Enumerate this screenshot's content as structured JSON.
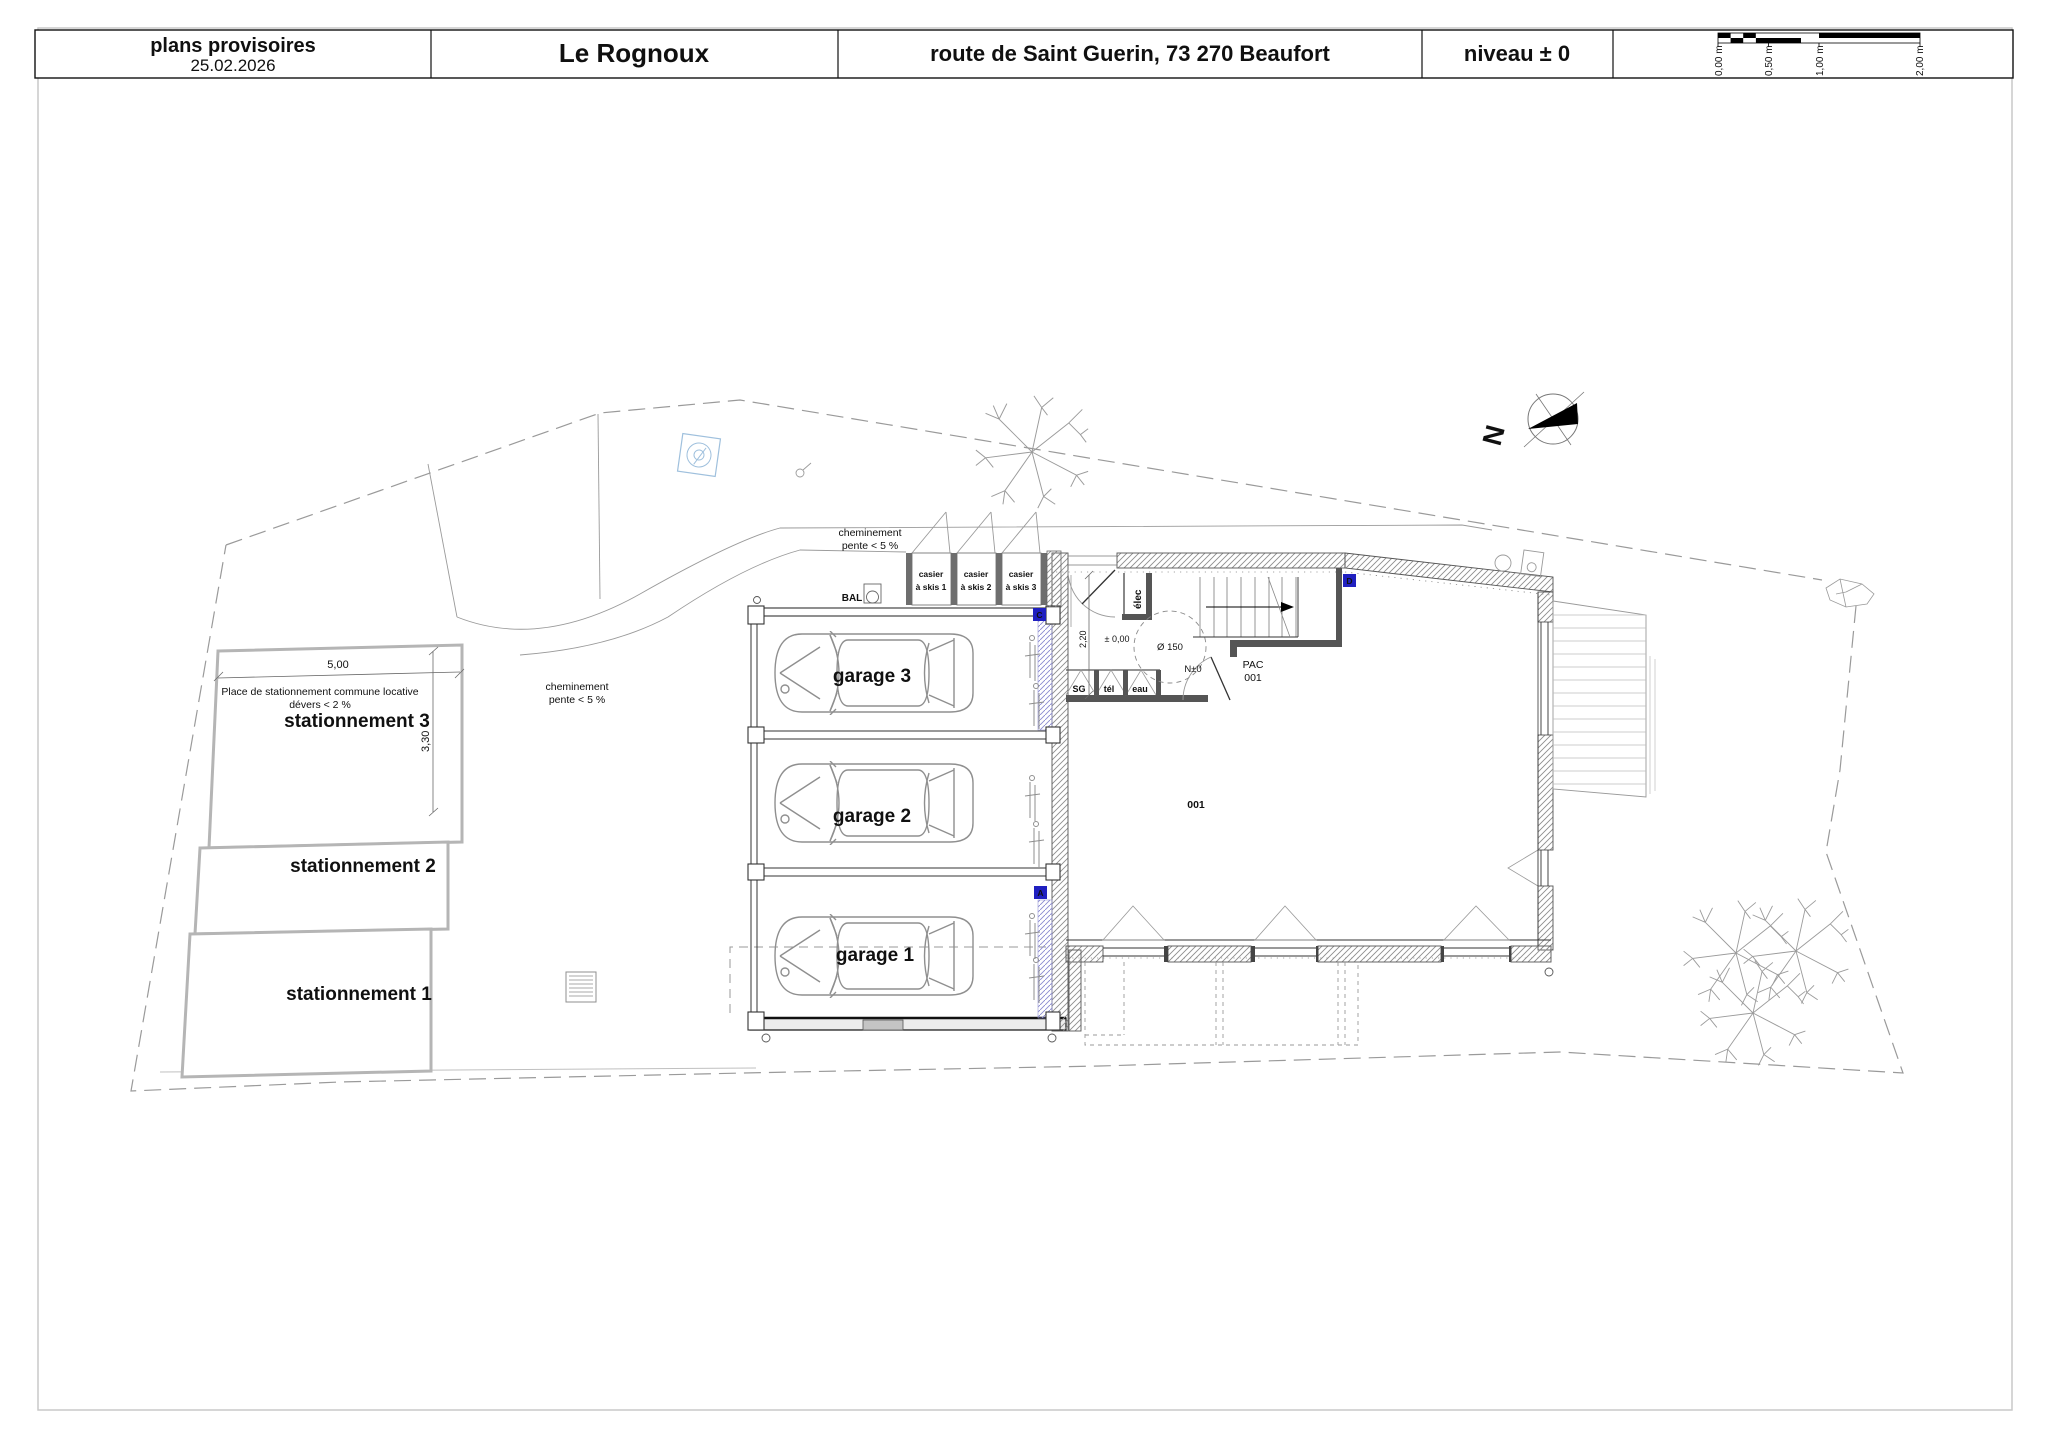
{
  "title_block": {
    "status": "plans provisoires",
    "date": "25.02.2026",
    "project": "Le Rognoux",
    "address": "route de Saint Guerin,  73 270 Beaufort",
    "level": "niveau ± 0",
    "scale_bar": {
      "labels": [
        "0,00 m",
        "0,50 m",
        "1,00 m",
        "2,00 m"
      ]
    }
  },
  "site": {
    "north_label": "N",
    "parking": {
      "note_line1": "Place de stationnement commune locative",
      "note_line2": "dévers < 2 %",
      "dim_width": "5,00",
      "dim_height": "3,30",
      "spaces": [
        "stationnement 3",
        "stationnement 2",
        "stationnement 1"
      ]
    },
    "notes": {
      "walkway_top_1": "cheminement",
      "walkway_top_2": "pente < 5 %",
      "walkway_mid_1": "cheminement",
      "walkway_mid_2": "pente < 5 %"
    }
  },
  "building": {
    "garages": [
      "garage 3",
      "garage 2",
      "garage 1"
    ],
    "mailbox": "BAL",
    "lockers": [
      [
        "casier",
        "à skis 1"
      ],
      [
        "casier",
        "à skis 2"
      ],
      [
        "casier",
        "à skis 3"
      ]
    ],
    "entry": {
      "elec": "élec",
      "dim": "2,20",
      "level_zero": "± 0,00",
      "turning_circle": "Ø 150",
      "level_tag": "N±0",
      "pac_line1": "PAC",
      "pac_line2": "001",
      "meters": [
        "SG",
        "tél",
        "eau"
      ],
      "room_number": "001"
    },
    "markers": [
      "C",
      "A",
      "D"
    ]
  }
}
